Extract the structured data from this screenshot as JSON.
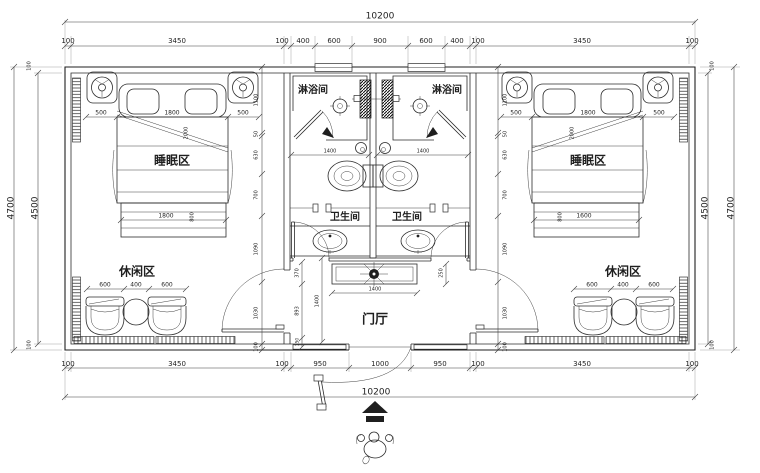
{
  "meta": {
    "title": "双间客房平面布置图 floor plan",
    "units": "mm",
    "line_color": "#1f1f1f",
    "background": "#ffffff"
  },
  "overall_dims": {
    "top_total": "10200",
    "bottom_total": "10200",
    "left_outer": "4700",
    "left_inner": "4500",
    "right_inner": "4500",
    "right_outer": "4700"
  },
  "dim_chains": {
    "top": [
      "100",
      "3450",
      "100",
      "400",
      "600",
      "900",
      "600",
      "400",
      "100",
      "3450",
      "100"
    ],
    "bottom": [
      "100",
      "3450",
      "100",
      "950",
      "1000",
      "950",
      "100",
      "3450",
      "100"
    ],
    "interior_vertical_left": [
      "1100",
      "50",
      "630",
      "700",
      "1090",
      "1030",
      "100"
    ],
    "interior_vertical_right": [
      "1100",
      "50",
      "630",
      "700",
      "1090",
      "1030",
      "100"
    ],
    "hall_side": [
      "370",
      "893",
      "150"
    ],
    "hall_depth": "1400",
    "cabinet_width": "1400",
    "cabinet_depth": "250",
    "bathroom_width": [
      "1400",
      "1400"
    ],
    "bed_left": [
      "500",
      "1800",
      "500"
    ],
    "bed_right": [
      "500",
      "1800",
      "500"
    ],
    "bed_foot_left": [
      "1800",
      "800"
    ],
    "bed_foot_right": [
      "1600",
      "800"
    ],
    "bed_diagonal": "2000",
    "lounge_left": [
      "600",
      "400",
      "600"
    ],
    "lounge_right": [
      "600",
      "400",
      "600"
    ]
  },
  "rooms": {
    "sleep_left": "睡眠区",
    "sleep_right": "睡眠区",
    "lounge_left": "休闲区",
    "lounge_right": "休闲区",
    "shower_left": "淋浴间",
    "shower_right": "淋浴间",
    "wc_left": "卫生间",
    "wc_right": "卫生间",
    "hall": "门厅"
  },
  "texts": [
    {
      "n": "dim-top-overall",
      "t": "10200",
      "x": 380,
      "y": 16,
      "s": 9
    },
    {
      "n": "dim-top",
      "t": "100",
      "x": 68,
      "y": 41,
      "s": 7
    },
    {
      "n": "dim-top",
      "t": "3450",
      "x": 177,
      "y": 41,
      "s": 7
    },
    {
      "n": "dim-top",
      "t": "100",
      "x": 282,
      "y": 41,
      "s": 7
    },
    {
      "n": "dim-top",
      "t": "400",
      "x": 303,
      "y": 41,
      "s": 7
    },
    {
      "n": "dim-top",
      "t": "600",
      "x": 334,
      "y": 41,
      "s": 7
    },
    {
      "n": "dim-top",
      "t": "900",
      "x": 380,
      "y": 41,
      "s": 7
    },
    {
      "n": "dim-top",
      "t": "600",
      "x": 426,
      "y": 41,
      "s": 7
    },
    {
      "n": "dim-top",
      "t": "400",
      "x": 457,
      "y": 41,
      "s": 7
    },
    {
      "n": "dim-top",
      "t": "100",
      "x": 478,
      "y": 41,
      "s": 7
    },
    {
      "n": "dim-top",
      "t": "3450",
      "x": 582,
      "y": 41,
      "s": 7
    },
    {
      "n": "dim-top",
      "t": "100",
      "x": 692,
      "y": 41,
      "s": 7
    },
    {
      "n": "dim-bottom",
      "t": "100",
      "x": 68,
      "y": 364,
      "s": 7
    },
    {
      "n": "dim-bottom",
      "t": "3450",
      "x": 177,
      "y": 364,
      "s": 7
    },
    {
      "n": "dim-bottom",
      "t": "100",
      "x": 282,
      "y": 364,
      "s": 7
    },
    {
      "n": "dim-bottom",
      "t": "950",
      "x": 320,
      "y": 364,
      "s": 7
    },
    {
      "n": "dim-bottom",
      "t": "1000",
      "x": 380,
      "y": 364,
      "s": 7
    },
    {
      "n": "dim-bottom",
      "t": "950",
      "x": 440,
      "y": 364,
      "s": 7
    },
    {
      "n": "dim-bottom",
      "t": "100",
      "x": 478,
      "y": 364,
      "s": 7
    },
    {
      "n": "dim-bottom",
      "t": "3450",
      "x": 582,
      "y": 364,
      "s": 7
    },
    {
      "n": "dim-bottom",
      "t": "100",
      "x": 692,
      "y": 364,
      "s": 7
    },
    {
      "n": "dim-bottom-overall",
      "t": "10200",
      "x": 376,
      "y": 392,
      "s": 9
    },
    {
      "n": "dim-left-outer",
      "t": "4700",
      "x": 11,
      "y": 208,
      "r": -90,
      "s": 9
    },
    {
      "n": "dim-left-inner",
      "t": "4500",
      "x": 35,
      "y": 208,
      "r": -90,
      "s": 9
    },
    {
      "n": "dim-right-inner",
      "t": "4500",
      "x": 705,
      "y": 208,
      "r": -90,
      "s": 9
    },
    {
      "n": "dim-right-outer",
      "t": "4700",
      "x": 731,
      "y": 208,
      "r": -90,
      "s": 9
    },
    {
      "n": "dim-wall",
      "t": "100",
      "x": 29,
      "y": 66,
      "r": -90,
      "s": 5
    },
    {
      "n": "dim-wall",
      "t": "100",
      "x": 29,
      "y": 345,
      "r": -90,
      "s": 5
    },
    {
      "n": "dim-wall",
      "t": "100",
      "x": 712,
      "y": 66,
      "r": -90,
      "s": 5
    },
    {
      "n": "dim-wall",
      "t": "100",
      "x": 712,
      "y": 345,
      "r": -90,
      "s": 5
    },
    {
      "n": "dim-bed",
      "t": "500",
      "x": 101,
      "y": 113,
      "s": 6
    },
    {
      "n": "dim-bed",
      "t": "1800",
      "x": 172,
      "y": 113,
      "s": 6
    },
    {
      "n": "dim-bed",
      "t": "500",
      "x": 243,
      "y": 113,
      "s": 6
    },
    {
      "n": "label-sleep-left",
      "t": "睡眠区",
      "x": 172,
      "y": 161,
      "s": 12,
      "b": 1
    },
    {
      "n": "dim-bed",
      "t": "2000",
      "x": 186,
      "y": 133,
      "r": -90,
      "s": 5
    },
    {
      "n": "dim-bed",
      "t": "1800",
      "x": 166,
      "y": 216,
      "s": 6
    },
    {
      "n": "dim-bed",
      "t": "800",
      "x": 192,
      "y": 217,
      "r": -90,
      "s": 5
    },
    {
      "n": "label-lounge-left",
      "t": "休闲区",
      "x": 137,
      "y": 272,
      "s": 12,
      "b": 1
    },
    {
      "n": "dim-lounge",
      "t": "600",
      "x": 105,
      "y": 285,
      "s": 6
    },
    {
      "n": "dim-lounge",
      "t": "400",
      "x": 136,
      "y": 285,
      "s": 6
    },
    {
      "n": "dim-lounge",
      "t": "600",
      "x": 167,
      "y": 285,
      "s": 6
    },
    {
      "n": "dim-chain",
      "t": "1100",
      "x": 256,
      "y": 100,
      "r": -90,
      "s": 5
    },
    {
      "n": "dim-chain",
      "t": "50",
      "x": 256,
      "y": 134,
      "r": -90,
      "s": 5
    },
    {
      "n": "dim-chain",
      "t": "630",
      "x": 256,
      "y": 155,
      "r": -90,
      "s": 5
    },
    {
      "n": "dim-chain",
      "t": "700",
      "x": 256,
      "y": 195,
      "r": -90,
      "s": 5
    },
    {
      "n": "dim-chain",
      "t": "1090",
      "x": 256,
      "y": 249,
      "r": -90,
      "s": 5
    },
    {
      "n": "dim-chain",
      "t": "1030",
      "x": 256,
      "y": 313,
      "r": -90,
      "s": 5
    },
    {
      "n": "dim-chain",
      "t": "100",
      "x": 256,
      "y": 347,
      "r": -90,
      "s": 5
    },
    {
      "n": "dim-chain",
      "t": "1100",
      "x": 505,
      "y": 100,
      "r": -90,
      "s": 5
    },
    {
      "n": "dim-chain",
      "t": "50",
      "x": 505,
      "y": 134,
      "r": -90,
      "s": 5
    },
    {
      "n": "dim-chain",
      "t": "630",
      "x": 505,
      "y": 155,
      "r": -90,
      "s": 5
    },
    {
      "n": "dim-chain",
      "t": "700",
      "x": 505,
      "y": 195,
      "r": -90,
      "s": 5
    },
    {
      "n": "dim-chain",
      "t": "1090",
      "x": 505,
      "y": 249,
      "r": -90,
      "s": 5
    },
    {
      "n": "dim-chain",
      "t": "1030",
      "x": 505,
      "y": 313,
      "r": -90,
      "s": 5
    },
    {
      "n": "dim-chain",
      "t": "100",
      "x": 505,
      "y": 347,
      "r": -90,
      "s": 5
    },
    {
      "n": "label-shower-left",
      "t": "淋浴间",
      "x": 313,
      "y": 90,
      "s": 10,
      "b": 1
    },
    {
      "n": "label-shower-right",
      "t": "淋浴间",
      "x": 447,
      "y": 90,
      "s": 10,
      "b": 1
    },
    {
      "n": "dim-bath",
      "t": "1400",
      "x": 330,
      "y": 151,
      "s": 5
    },
    {
      "n": "dim-bath",
      "t": "1400",
      "x": 423,
      "y": 151,
      "s": 5
    },
    {
      "n": "label-wc-left",
      "t": "卫生间",
      "x": 345,
      "y": 217,
      "s": 10,
      "b": 1
    },
    {
      "n": "label-wc-right",
      "t": "卫生间",
      "x": 407,
      "y": 217,
      "s": 10,
      "b": 1
    },
    {
      "n": "dim-hall",
      "t": "370",
      "x": 297,
      "y": 273,
      "r": -90,
      "s": 5
    },
    {
      "n": "dim-hall",
      "t": "893",
      "x": 297,
      "y": 311,
      "r": -90,
      "s": 5
    },
    {
      "n": "dim-hall",
      "t": "150",
      "x": 297,
      "y": 342,
      "r": -90,
      "s": 4.5
    },
    {
      "n": "dim-hall",
      "t": "1400",
      "x": 317,
      "y": 301,
      "r": -90,
      "s": 5
    },
    {
      "n": "dim-cabinet",
      "t": "250",
      "x": 441,
      "y": 273,
      "r": -90,
      "s": 5
    },
    {
      "n": "dim-cabinet",
      "t": "1400",
      "x": 375,
      "y": 289,
      "s": 5
    },
    {
      "n": "label-hall",
      "t": "门厅",
      "x": 375,
      "y": 320,
      "s": 13,
      "b": 1
    },
    {
      "n": "dim-bed",
      "t": "500",
      "x": 516,
      "y": 113,
      "s": 6
    },
    {
      "n": "dim-bed",
      "t": "1800",
      "x": 588,
      "y": 113,
      "s": 6
    },
    {
      "n": "dim-bed",
      "t": "500",
      "x": 659,
      "y": 113,
      "s": 6
    },
    {
      "n": "label-sleep-right",
      "t": "睡眠区",
      "x": 588,
      "y": 161,
      "s": 12,
      "b": 1
    },
    {
      "n": "dim-bed",
      "t": "2000",
      "x": 572,
      "y": 133,
      "r": -90,
      "s": 5
    },
    {
      "n": "dim-bed",
      "t": "1600",
      "x": 584,
      "y": 216,
      "s": 6
    },
    {
      "n": "dim-bed",
      "t": "800",
      "x": 560,
      "y": 217,
      "r": -90,
      "s": 5
    },
    {
      "n": "label-lounge-right",
      "t": "休闲区",
      "x": 623,
      "y": 272,
      "s": 12,
      "b": 1
    },
    {
      "n": "dim-lounge",
      "t": "600",
      "x": 592,
      "y": 285,
      "s": 6
    },
    {
      "n": "dim-lounge",
      "t": "400",
      "x": 623,
      "y": 285,
      "s": 6
    },
    {
      "n": "dim-lounge",
      "t": "600",
      "x": 654,
      "y": 285,
      "s": 6
    }
  ]
}
